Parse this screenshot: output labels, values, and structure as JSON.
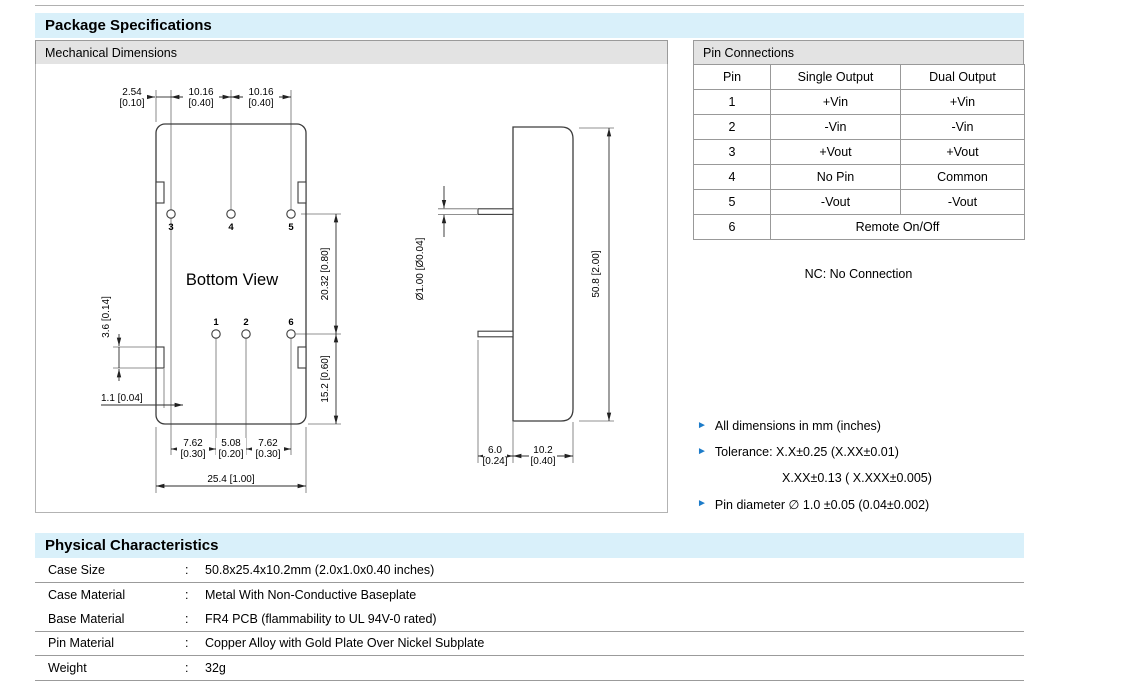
{
  "page": {
    "title": "Package Specifications"
  },
  "mechanical": {
    "panel_title": "Mechanical Dimensions",
    "view_label": "Bottom View",
    "pins": [
      "1",
      "2",
      "3",
      "4",
      "5",
      "6"
    ],
    "dims": {
      "top_offset_mm": "2.54",
      "top_offset_in": "[0.10]",
      "top_pitch1_mm": "10.16",
      "top_pitch1_in": "[0.40]",
      "top_pitch2_mm": "10.16",
      "top_pitch2_in": "[0.40]",
      "row_gap": "20.32 [0.80]",
      "bottom_gap": "15.2 [0.60]",
      "tab_height": "3.6 [0.14]",
      "edge_offset": "1.1 [0.04]",
      "bot1_mm": "7.62",
      "bot1_in": "[0.30]",
      "bot2_mm": "5.08",
      "bot2_in": "[0.20]",
      "bot3_mm": "7.62",
      "bot3_in": "[0.30]",
      "total_width": "25.4 [1.00]",
      "pin_diameter": "Ø1.00 [Ø0.04]",
      "total_height": "50.8 [2.00]",
      "pin_length_mm": "6.0",
      "pin_length_in": "[0.24]",
      "case_depth_mm": "10.2",
      "case_depth_in": "[0.40]"
    }
  },
  "pin_connections": {
    "title": "Pin Connections",
    "columns": [
      "Pin",
      "Single Output",
      "Dual Output"
    ],
    "rows": [
      {
        "pin": "1",
        "single": "+Vin",
        "dual": "+Vin"
      },
      {
        "pin": "2",
        "single": "-Vin",
        "dual": "-Vin"
      },
      {
        "pin": "3",
        "single": "+Vout",
        "dual": "+Vout"
      },
      {
        "pin": "4",
        "single": "No Pin",
        "dual": "Common"
      },
      {
        "pin": "5",
        "single": "-Vout",
        "dual": "-Vout"
      },
      {
        "pin": "6",
        "span": "Remote On/Off"
      }
    ],
    "note": "NC: No Connection"
  },
  "notes": {
    "bullet": "►",
    "items": [
      "All dimensions in mm (inches)",
      "Tolerance: X.X±0.25 (X.XX±0.01)",
      "X.XX±0.13 ( X.XXX±0.005)",
      "Pin diameter ∅ 1.0 ±0.05 (0.04±0.002)"
    ]
  },
  "physical": {
    "title": "Physical Characteristics",
    "separator": ":",
    "rows": [
      {
        "label": "Case Size",
        "value": "50.8x25.4x10.2mm (2.0x1.0x0.40 inches)"
      },
      {
        "label": "Case Material",
        "value": "Metal With Non-Conductive Baseplate"
      },
      {
        "label": "Base Material",
        "value": "FR4 PCB (flammability to UL 94V-0 rated)"
      },
      {
        "label": "Pin Material",
        "value": "Copper Alloy with Gold Plate Over Nickel Subplate"
      },
      {
        "label": "Weight",
        "value": "32g"
      }
    ]
  },
  "colors": {
    "accent_bar": "#d9f0fa",
    "panel_bar": "#e3e3e3",
    "bullet_blue": "#1d7cc9"
  }
}
